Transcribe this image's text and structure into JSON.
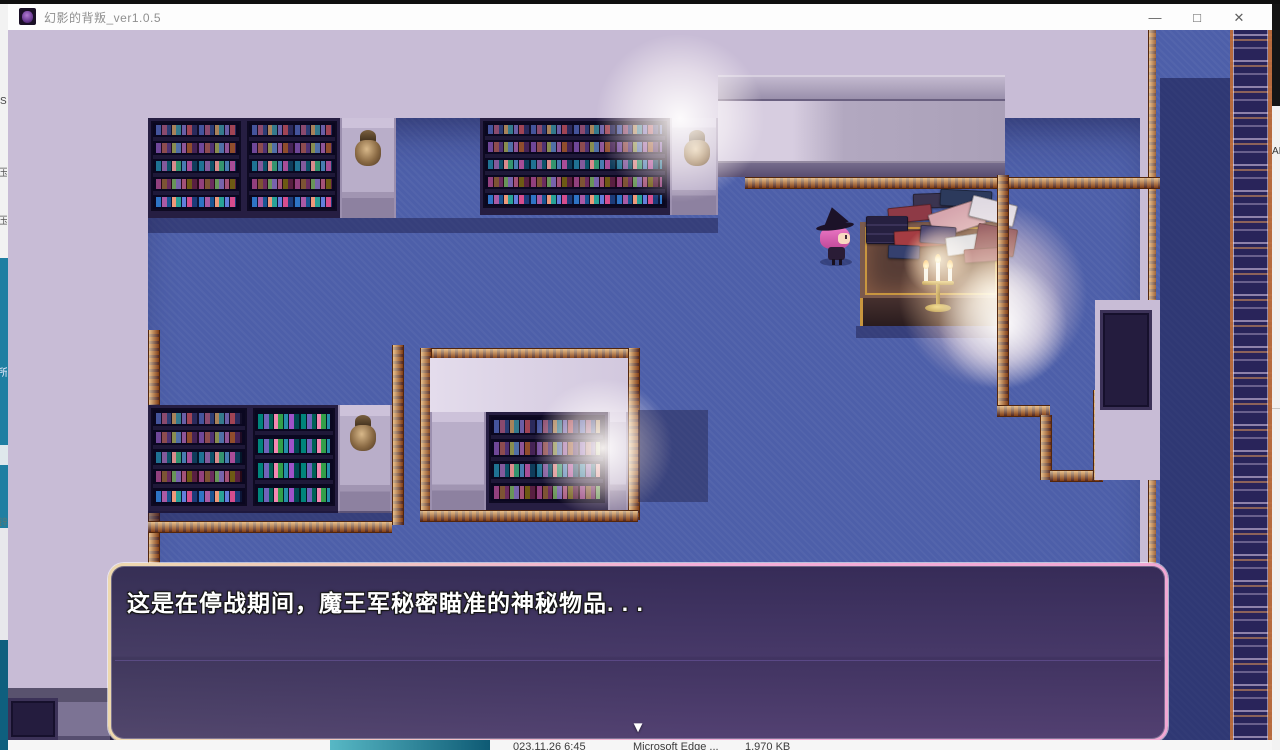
{
  "window": {
    "title": "幻影的背叛_ver1.0.5",
    "controls": {
      "minimize": "—",
      "maximize": "□",
      "close": "✕"
    }
  },
  "dialogue": {
    "text": "这是在停战期间，魔王军秘密瞄准的神秘物品. . .",
    "continue_indicator": "▼"
  },
  "edges": {
    "left_fragments": [
      "S",
      "压",
      "压",
      "所",
      "锌"
    ],
    "right_fragment": "AI"
  },
  "taskbar": {
    "date": "023.11.26 6:45",
    "app": "Microsoft Edge ...",
    "size": "1,970 KB"
  },
  "colors": {
    "floor_blue": "#4d5fa9",
    "wall_lavender": "#c8bcd6",
    "dialog_border_pink": "#f4aed8",
    "carpet_gold": "#a65c28",
    "lace_navy": "#29245a"
  }
}
